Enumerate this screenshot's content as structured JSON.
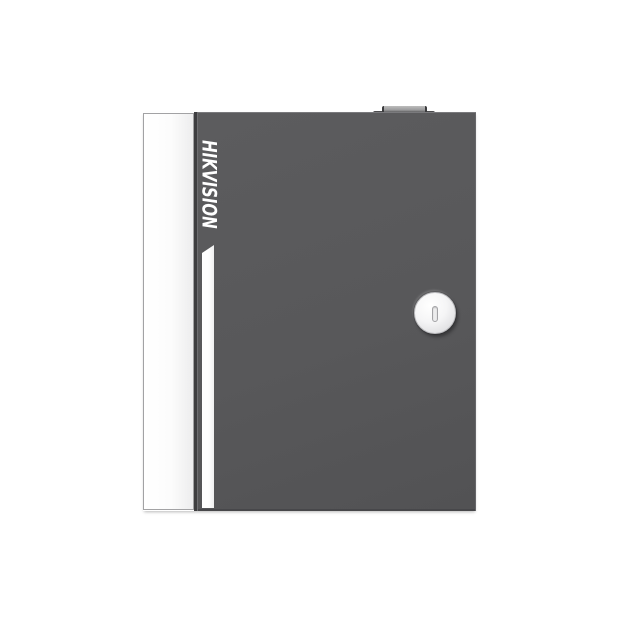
{
  "product": {
    "brand": "HIKVISION"
  },
  "icons": {
    "keyhole": "keyhole-icon (vertical rounded slot)"
  },
  "colors": {
    "background": "#ffffff",
    "door_gray": "#58585a",
    "door_edge_dark": "#3e3e40",
    "panel_white": "#fcfcfc",
    "panel_border": "#a2a2a4",
    "stripe_white": "#fdfdfd",
    "logo_white": "#ffffff",
    "lock_face": "#f5f5f6",
    "hinge_gray": "#4b4b4d"
  }
}
